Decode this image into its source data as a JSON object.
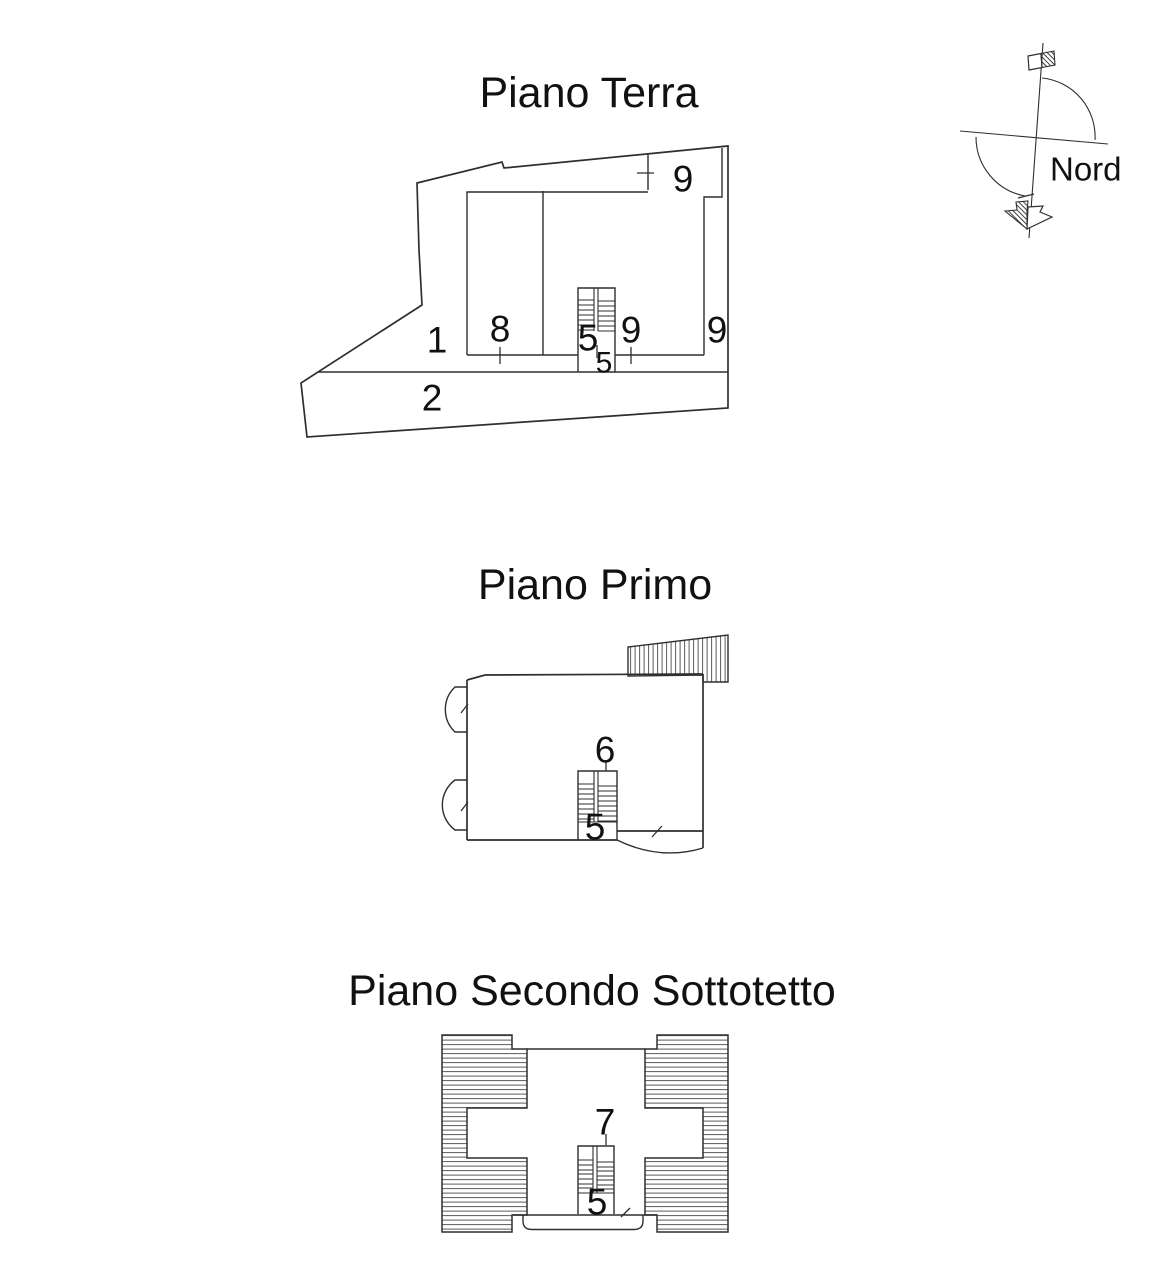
{
  "colors": {
    "background": "#ffffff",
    "line": "#2f2f2f",
    "text": "#111111"
  },
  "floors": {
    "terra": {
      "title": "Piano Terra",
      "labels": {
        "area1": "1",
        "area2": "2",
        "room8": "8",
        "stair5": "5",
        "landing5": "5",
        "mid9": "9",
        "right9": "9",
        "top9": "9"
      }
    },
    "primo": {
      "title": "Piano Primo",
      "labels": {
        "room6": "6",
        "stair5": "5"
      }
    },
    "secondo": {
      "title": "Piano Secondo Sottotetto",
      "labels": {
        "room7": "7",
        "stair5": "5"
      }
    }
  },
  "compass": {
    "label": "Nord"
  }
}
